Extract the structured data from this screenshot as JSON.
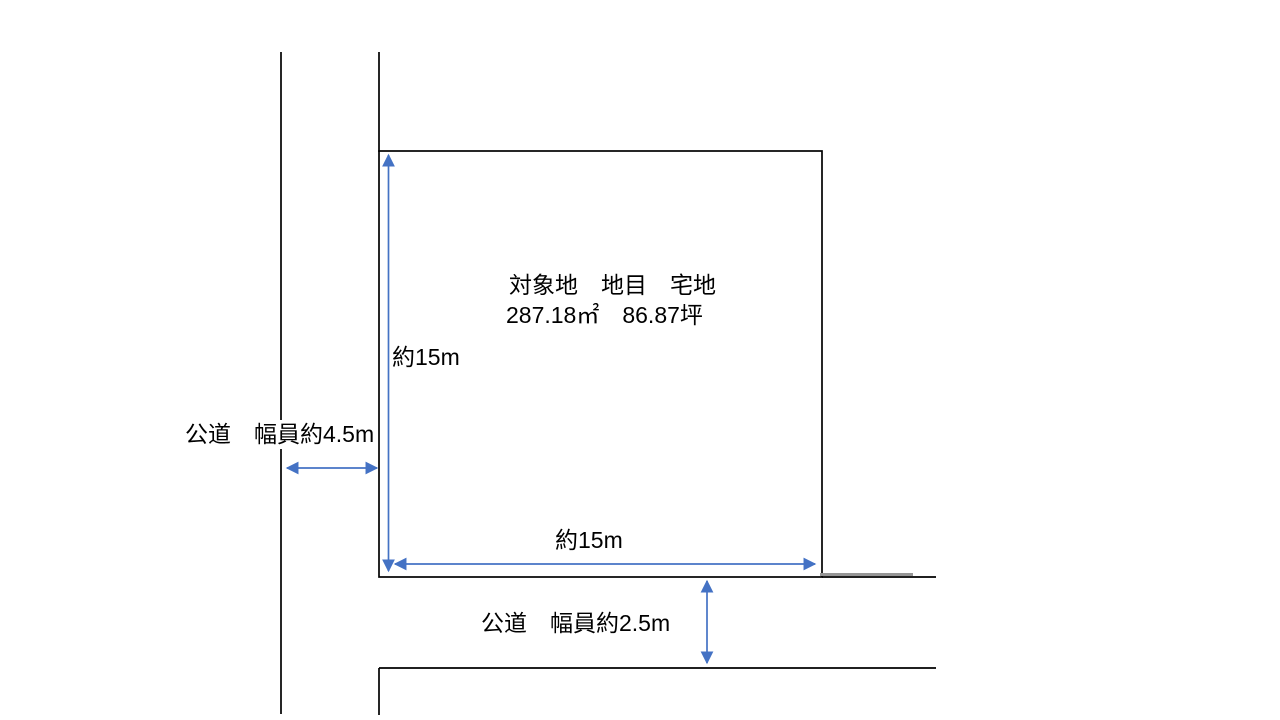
{
  "colors": {
    "arrow_blue": "#4472C4",
    "line_black": "#000000",
    "grey_segment": "#969696"
  },
  "parcel": {
    "title": "対象地　地目　宅地",
    "area": "287.18㎡　86.87坪",
    "height_label": "約15m",
    "width_label": "約15m"
  },
  "roads": {
    "left_label": "公道　幅員約4.5m",
    "bottom_label": "公道　幅員約2.5m"
  }
}
